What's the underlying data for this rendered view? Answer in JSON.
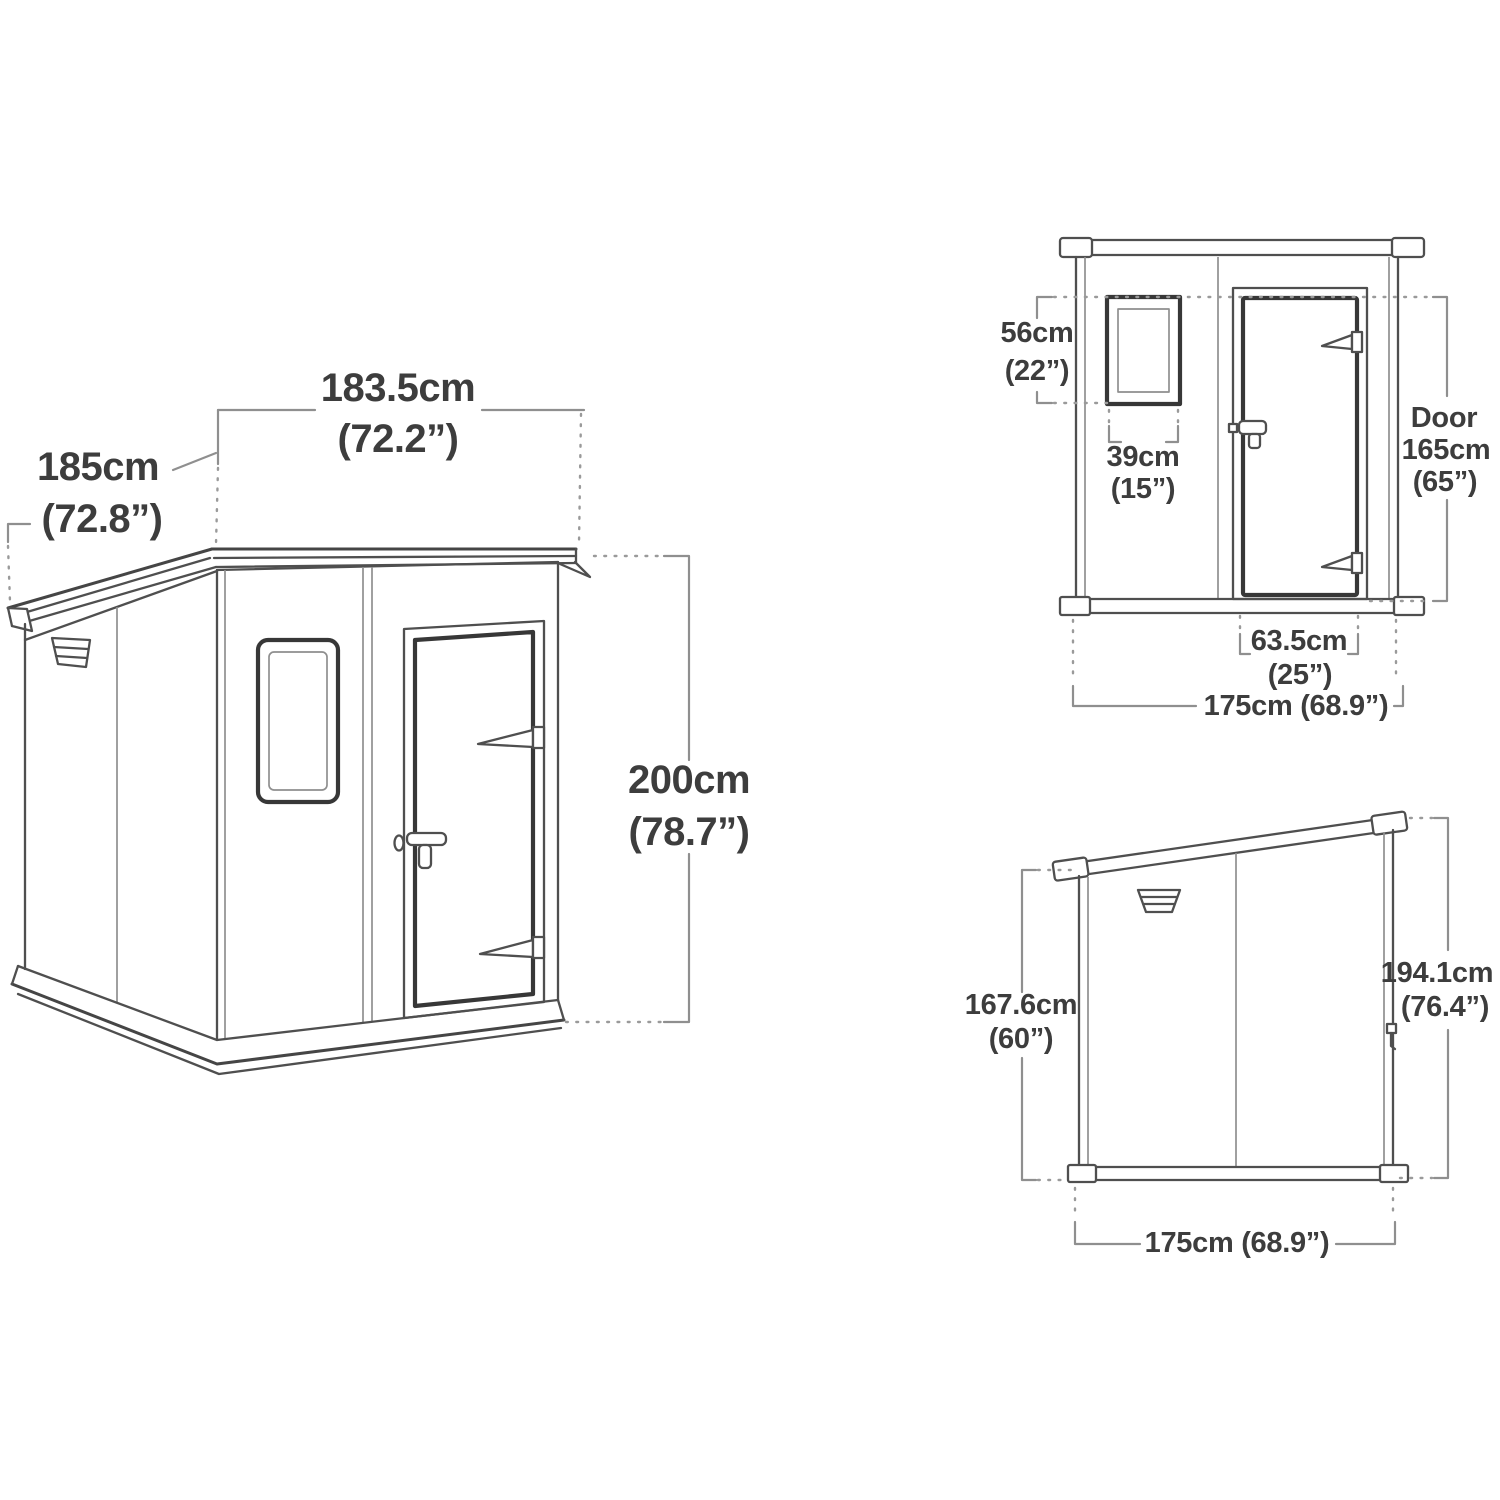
{
  "colors": {
    "background": "#ffffff",
    "drawing_line": "#4f4f4f",
    "bold_line": "#373737",
    "dimension_line": "#8f8f8f",
    "dotted_line": "#9a9a9a",
    "text": "#3d3d3d"
  },
  "views": {
    "main": {
      "title": "isometric-shed-view",
      "labels": {
        "width_cm": "183.5cm",
        "width_in": "(72.2”)",
        "depth_cm": "185cm",
        "depth_in": "(72.8”)",
        "height_cm": "200cm",
        "height_in": "(78.7”)"
      }
    },
    "front": {
      "title": "front-elevation-view",
      "labels": {
        "window_height_cm": "56cm",
        "window_height_in": "(22”)",
        "window_width_cm": "39cm",
        "window_width_in": "(15”)",
        "door_title": "Door",
        "door_height_cm": "165cm",
        "door_height_in": "(65”)",
        "door_width_cm": "63.5cm",
        "door_width_in": "(25”)",
        "overall_width": "175cm (68.9”)"
      }
    },
    "side": {
      "title": "side-elevation-view",
      "labels": {
        "rear_height_cm": "167.6cm",
        "rear_height_in": "(60”)",
        "front_height_cm": "194.1cm",
        "front_height_in": "(76.4”)",
        "overall_depth": "175cm (68.9”)"
      }
    }
  }
}
